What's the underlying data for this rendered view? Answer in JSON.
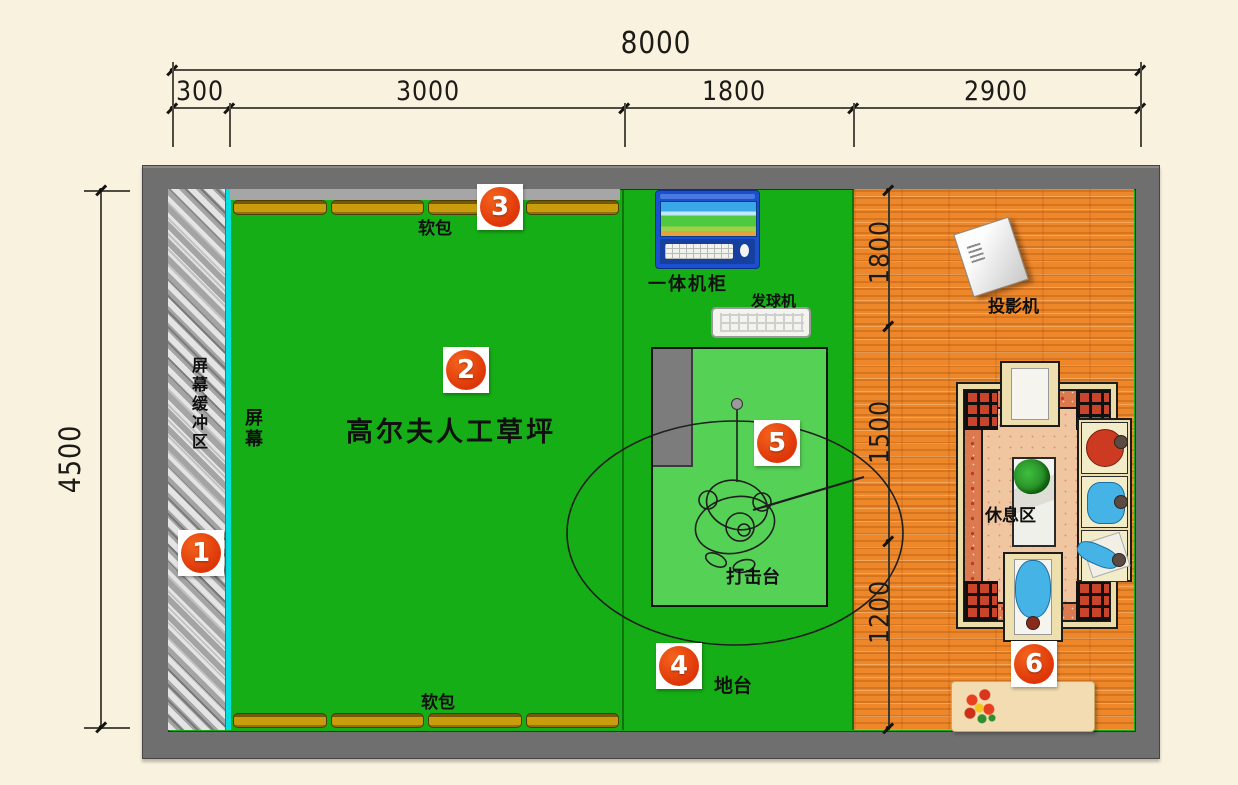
{
  "colors": {
    "background": "#F9F2DF",
    "wall": "#6E6E6E",
    "turf_green": "#16AE16",
    "platform_green": "#55D155",
    "wood_floor": "#EE8729",
    "soft_pack": "#C99C0C",
    "screen_line": "#00DFDF",
    "marker_red": "#DE3608"
  },
  "dimensions": {
    "overall_width": "8000",
    "width_segments": [
      "300",
      "3000",
      "1800",
      "2900"
    ],
    "overall_height": "4500",
    "depth_segments": [
      "1800",
      "1500",
      "1200"
    ]
  },
  "labels": {
    "screen_buffer": "屏幕缓冲区",
    "screen": "屏幕",
    "soft_pack_top": "软包",
    "soft_pack_bottom": "软包",
    "turf": "高尔夫人工草坪",
    "cabinet": "一体机柜",
    "ball_machine": "发球机",
    "strike_platform": "打击台",
    "floor_platform": "地台",
    "projector": "投影机",
    "rest_area": "休息区"
  },
  "markers": {
    "m1": "1",
    "m2": "2",
    "m3": "3",
    "m4": "4",
    "m5": "5",
    "m6": "6"
  }
}
